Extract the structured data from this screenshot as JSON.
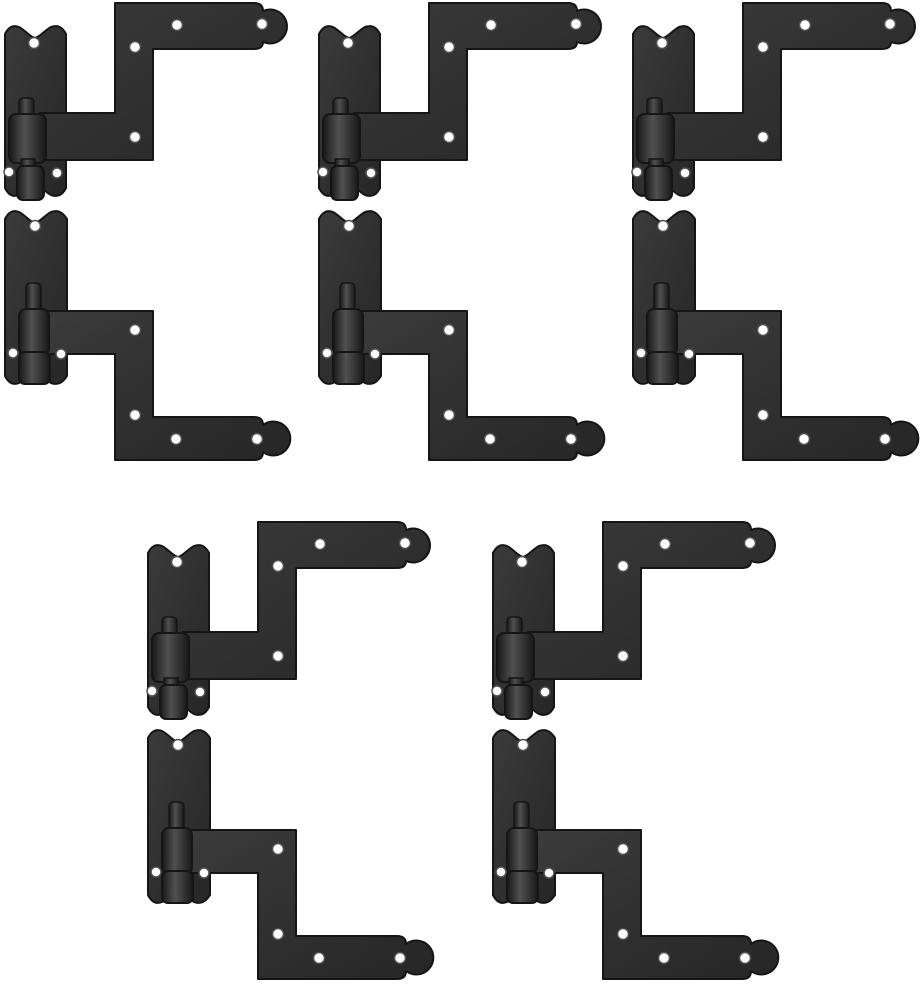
{
  "page": {
    "background": "#ffffff"
  },
  "image": {
    "alt": "Ten black wrought-iron L-shaped shutter hinges shown as five pairs on a white background",
    "canvas": {
      "width": 922,
      "height": 985
    },
    "colors": {
      "background": "#ffffff",
      "iron_light": "#3b3b3b",
      "iron": "#303030",
      "iron_deep": "#262626",
      "iron_dark": "#181818",
      "iron_highlight": "#505050",
      "outline": "#151515",
      "hole_fill": "#ffffff",
      "hole_ring": "#4f4f4f"
    },
    "sets": [
      {
        "x": 0,
        "y": 0
      },
      {
        "x": 314,
        "y": 0
      },
      {
        "x": 628,
        "y": 0
      },
      {
        "x": 143,
        "y": 519
      },
      {
        "x": 488,
        "y": 519
      }
    ]
  }
}
